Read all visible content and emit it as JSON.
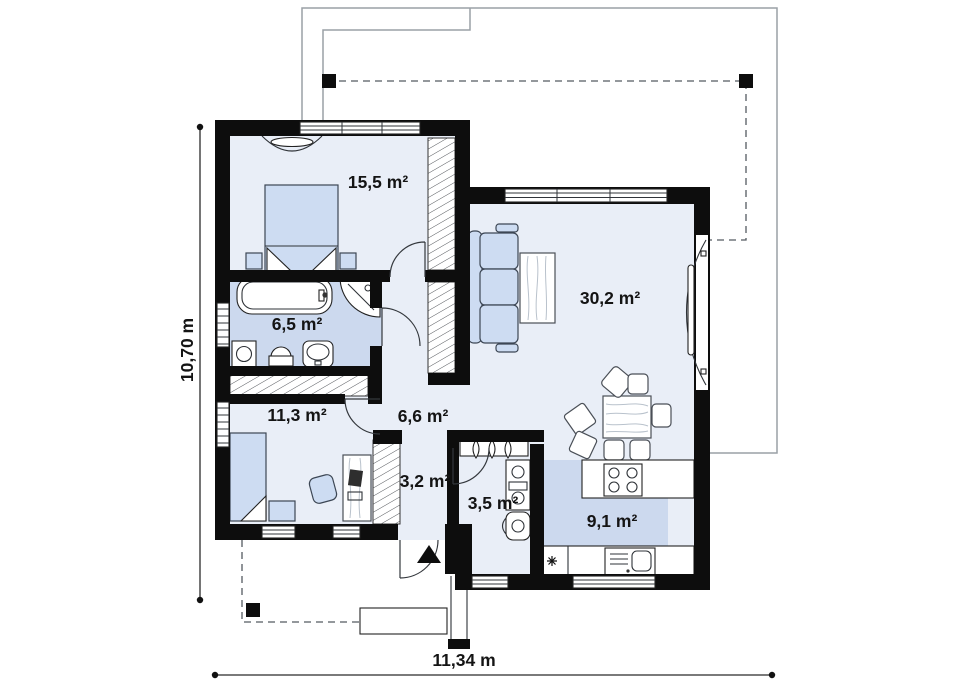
{
  "plan": {
    "rooms": [
      {
        "id": "bedroom-1",
        "area": "15,5 m²"
      },
      {
        "id": "living-room",
        "area": "30,2 m²"
      },
      {
        "id": "bathroom",
        "area": "6,5 m²"
      },
      {
        "id": "bedroom-2",
        "area": "11,3 m²"
      },
      {
        "id": "hallway",
        "area": "6,6 m²"
      },
      {
        "id": "hall-closet",
        "area": "3,2 m²"
      },
      {
        "id": "utility",
        "area": "3,5 m²"
      },
      {
        "id": "kitchen",
        "area": "9,1 m²"
      }
    ],
    "dimensions": {
      "width": "11,34 m",
      "height": "10,70 m"
    },
    "colors": {
      "wall": "#0d0d0d",
      "floor": "#e9eef7",
      "floor_accent": "#ccd9ee",
      "furniture": "#cddcf2",
      "roof_line": "#9aa0a6"
    }
  }
}
